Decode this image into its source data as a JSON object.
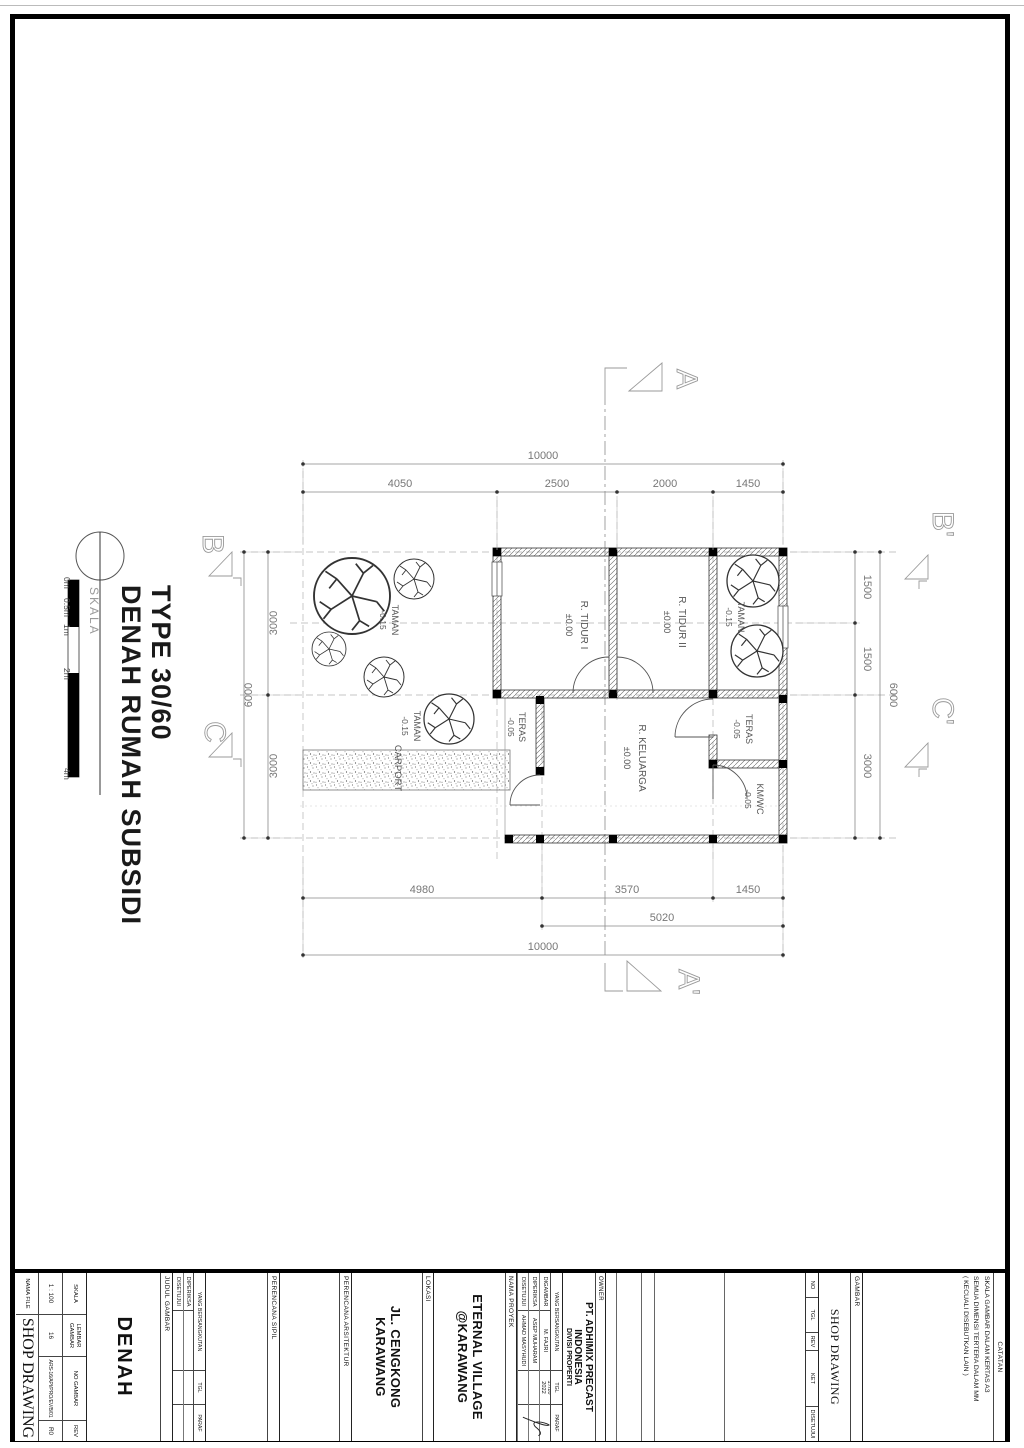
{
  "title_bubble": {
    "line1": "DENAH RUMAH SUBSIDI",
    "line2": "TYPE 30/60",
    "skala_label": "SKALA",
    "scale_ticks": [
      "0m",
      "0.5m",
      "1m",
      "2m",
      "4m"
    ]
  },
  "plan": {
    "dims": {
      "top_total": "10000",
      "top": [
        "4050",
        "2500",
        "2000",
        "1450"
      ],
      "bottom": [
        "4980",
        "3570",
        "1450"
      ],
      "bottom_partial": "5020",
      "bottom_total": "10000",
      "right": [
        "1500",
        "1500",
        "3000"
      ],
      "right_total": "6000",
      "left": [
        "3000",
        "3000"
      ],
      "left_total": "6000"
    },
    "rooms": {
      "tidur1": {
        "name": "R. TIDUR I",
        "level": "±0.00"
      },
      "tidur2": {
        "name": "R. TIDUR II",
        "level": "±0.00"
      },
      "keluarga": {
        "name": "R. KELUARGA",
        "level": "±0.00"
      },
      "teras_kiri": {
        "name": "TERAS",
        "level": "-0.05"
      },
      "teras_kanan": {
        "name": "TERAS",
        "level": "-0.05"
      },
      "kmwc": {
        "name": "KM/WC",
        "level": "-0.05"
      },
      "taman_kiri": {
        "name": "TAMAN",
        "level": "-0.15"
      },
      "taman_tengah": {
        "name": "TAMAN",
        "level": "-0.15"
      },
      "taman_kanan": {
        "name": "TAMAN",
        "level": "-0.15"
      },
      "carport": {
        "name": "CARPORT"
      }
    },
    "sections": {
      "a": "A",
      "a_prime": "A'",
      "b": "B",
      "b_prime": "B'",
      "c": "C",
      "c_prime": "C'"
    }
  },
  "titleblock": {
    "catatan": {
      "label": "CATATAN",
      "notes": [
        "SKALA GAMBAR DALAM KERTAS A3",
        "SEMUA DIMENSI TERTERA DALAM MM",
        "( KECUALI DISEBUTKAN LAIN )"
      ]
    },
    "gambar": {
      "label": "GAMBAR",
      "value": "SHOP DRAWING"
    },
    "revisi": {
      "headers": [
        "NO",
        "TGL",
        "REV",
        "KET",
        "DISETUJUI"
      ]
    },
    "owner": {
      "label": "OWNER",
      "line1": "PT. ADHIMIX PRECAST",
      "line2": "INDONESIA",
      "line3": "DIVISI PROPERTI"
    },
    "approval": {
      "header": "YANG BERSANGKUTAN",
      "tgl": "TGL",
      "paraf": "PARAF",
      "rows": [
        {
          "role": "DIGAMBAR",
          "name": "M. FAJRI",
          "tgl": "17/10\n2022"
        },
        {
          "role": "DIPERIKSA",
          "name": "ASEP MUHARAM",
          "tgl": ""
        },
        {
          "role": "DISETUJUI",
          "name": "AHMAD MASYHUDI",
          "tgl": ""
        }
      ]
    },
    "proyek": {
      "label": "NAMA PROYEK",
      "line1": "ETERNAL VILLAGE",
      "line2": "@KARAWANG"
    },
    "lokasi": {
      "label": "LOKASI",
      "line1": "JL. CENGKONG",
      "line2": "KARAWANG"
    },
    "arsitektur": {
      "label": "PERENCANA ARSITEKTUR"
    },
    "sipil": {
      "label": "PERENCANA SIPIL"
    },
    "approval2": {
      "header": "YANG BERSANGKUTAN",
      "tgl": "TGL",
      "paraf": "PARAF",
      "rows": [
        {
          "role": "DIPERIKSA"
        },
        {
          "role": "DISETUJUI"
        }
      ]
    },
    "judul": {
      "label": "JUDUL GAMBAR",
      "value": "DENAH"
    },
    "meta": {
      "headers": [
        "SKALA",
        "LEMBAR GAMBAR",
        "NO GAMBAR",
        "REV"
      ],
      "values": [
        "1 : 100",
        "16",
        "ARS-16/API/PRO/EV/B/01",
        "R0"
      ],
      "nama_file_label": "NAMA FILE",
      "nama_file_value": "SHOP DRAWING"
    }
  }
}
